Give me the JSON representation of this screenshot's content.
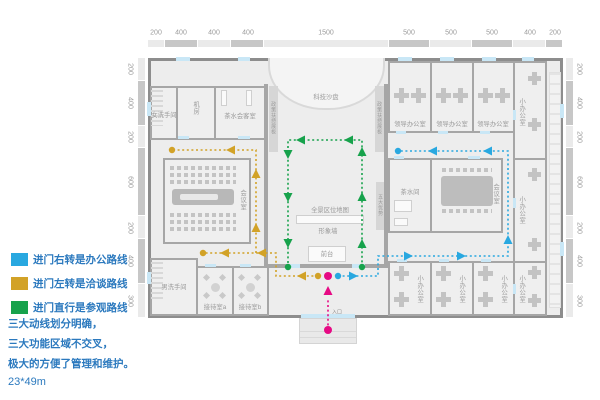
{
  "legend": {
    "items": [
      {
        "label": "进门右转是办公路线",
        "color": "#29a8e0"
      },
      {
        "label": "进门左转是洽谈路线",
        "color": "#d2a227"
      },
      {
        "label": "进门直行是参观路线",
        "color": "#17a24c"
      }
    ],
    "notes": [
      "三大动线划分明确，",
      "三大功能区域不交叉，",
      "极大的方便了管理和维护。"
    ],
    "dimensions": "23*49m"
  },
  "rulers": {
    "top_values": [
      200,
      400,
      400,
      400,
      1500,
      500,
      500,
      500,
      400,
      200
    ],
    "side_values": [
      200,
      400,
      200,
      600,
      200,
      400,
      300
    ]
  },
  "rooms": {
    "women_wc": "女洗手间",
    "machine": "机房",
    "tea_reception": "茶水会客室",
    "lecture": "会议室",
    "men_wc": "男洗手间",
    "reception_a": "接待室a",
    "reception_b": "接待室b",
    "leader_office": "领导办公室",
    "small_office": "小办公室",
    "tea_room": "茶水间",
    "meeting": "会议室"
  },
  "hall": {
    "sand_table": "科技沙盘",
    "policy_board": "政策扶持展板",
    "advantages": "五大优势",
    "location_map": "全景区位地图",
    "image_wall": "形象墙",
    "front_desk": "前台",
    "entrance": "入口"
  },
  "routes": [
    {
      "name": "office-route",
      "color": "#29a8e0",
      "segments": [
        [
          [
            338,
            276
          ],
          [
            378,
            276
          ],
          [
            378,
            256
          ],
          [
            508,
            256
          ],
          [
            508,
            151
          ],
          [
            398,
            151
          ]
        ]
      ],
      "dots": [
        [
          338,
          276
        ],
        [
          398,
          151
        ]
      ],
      "arrows": [
        [
          353,
          276,
          "right"
        ],
        [
          408,
          256,
          "right"
        ],
        [
          461,
          256,
          "right"
        ],
        [
          508,
          240,
          "up"
        ],
        [
          488,
          151,
          "left"
        ],
        [
          433,
          151,
          "left"
        ]
      ]
    },
    {
      "name": "negotiation-route",
      "color": "#d2a227",
      "segments": [
        [
          [
            318,
            276
          ],
          [
            276,
            276
          ],
          [
            276,
            253
          ],
          [
            203,
            253
          ]
        ],
        [
          [
            256,
            253
          ],
          [
            256,
            150
          ],
          [
            172,
            150
          ]
        ]
      ],
      "dots": [
        [
          318,
          276
        ],
        [
          203,
          253
        ],
        [
          172,
          150
        ]
      ],
      "arrows": [
        [
          302,
          276,
          "left"
        ],
        [
          262,
          253,
          "left"
        ],
        [
          225,
          253,
          "left"
        ],
        [
          256,
          228,
          "up"
        ],
        [
          256,
          174,
          "up"
        ],
        [
          231,
          150,
          "left"
        ]
      ]
    },
    {
      "name": "tour-route",
      "color": "#17a24c",
      "segments": [
        [
          [
            362,
            267
          ],
          [
            362,
            140
          ],
          [
            288,
            140
          ],
          [
            288,
            267
          ]
        ]
      ],
      "dots": [
        [
          362,
          267
        ],
        [
          288,
          267
        ]
      ],
      "arrows": [
        [
          362,
          244,
          "up"
        ],
        [
          362,
          197,
          "up"
        ],
        [
          362,
          152,
          "up"
        ],
        [
          349,
          140,
          "left"
        ],
        [
          301,
          140,
          "left"
        ],
        [
          288,
          154,
          "down"
        ],
        [
          288,
          197,
          "down"
        ],
        [
          288,
          243,
          "down"
        ]
      ]
    },
    {
      "name": "entrance-route",
      "color": "#e60a84",
      "segments": [
        [
          [
            328,
            330
          ],
          [
            328,
            298
          ]
        ]
      ],
      "dots": [
        [
          328,
          330
        ],
        [
          328,
          276
        ]
      ],
      "arrows": [
        [
          328,
          291,
          "up"
        ]
      ]
    }
  ]
}
